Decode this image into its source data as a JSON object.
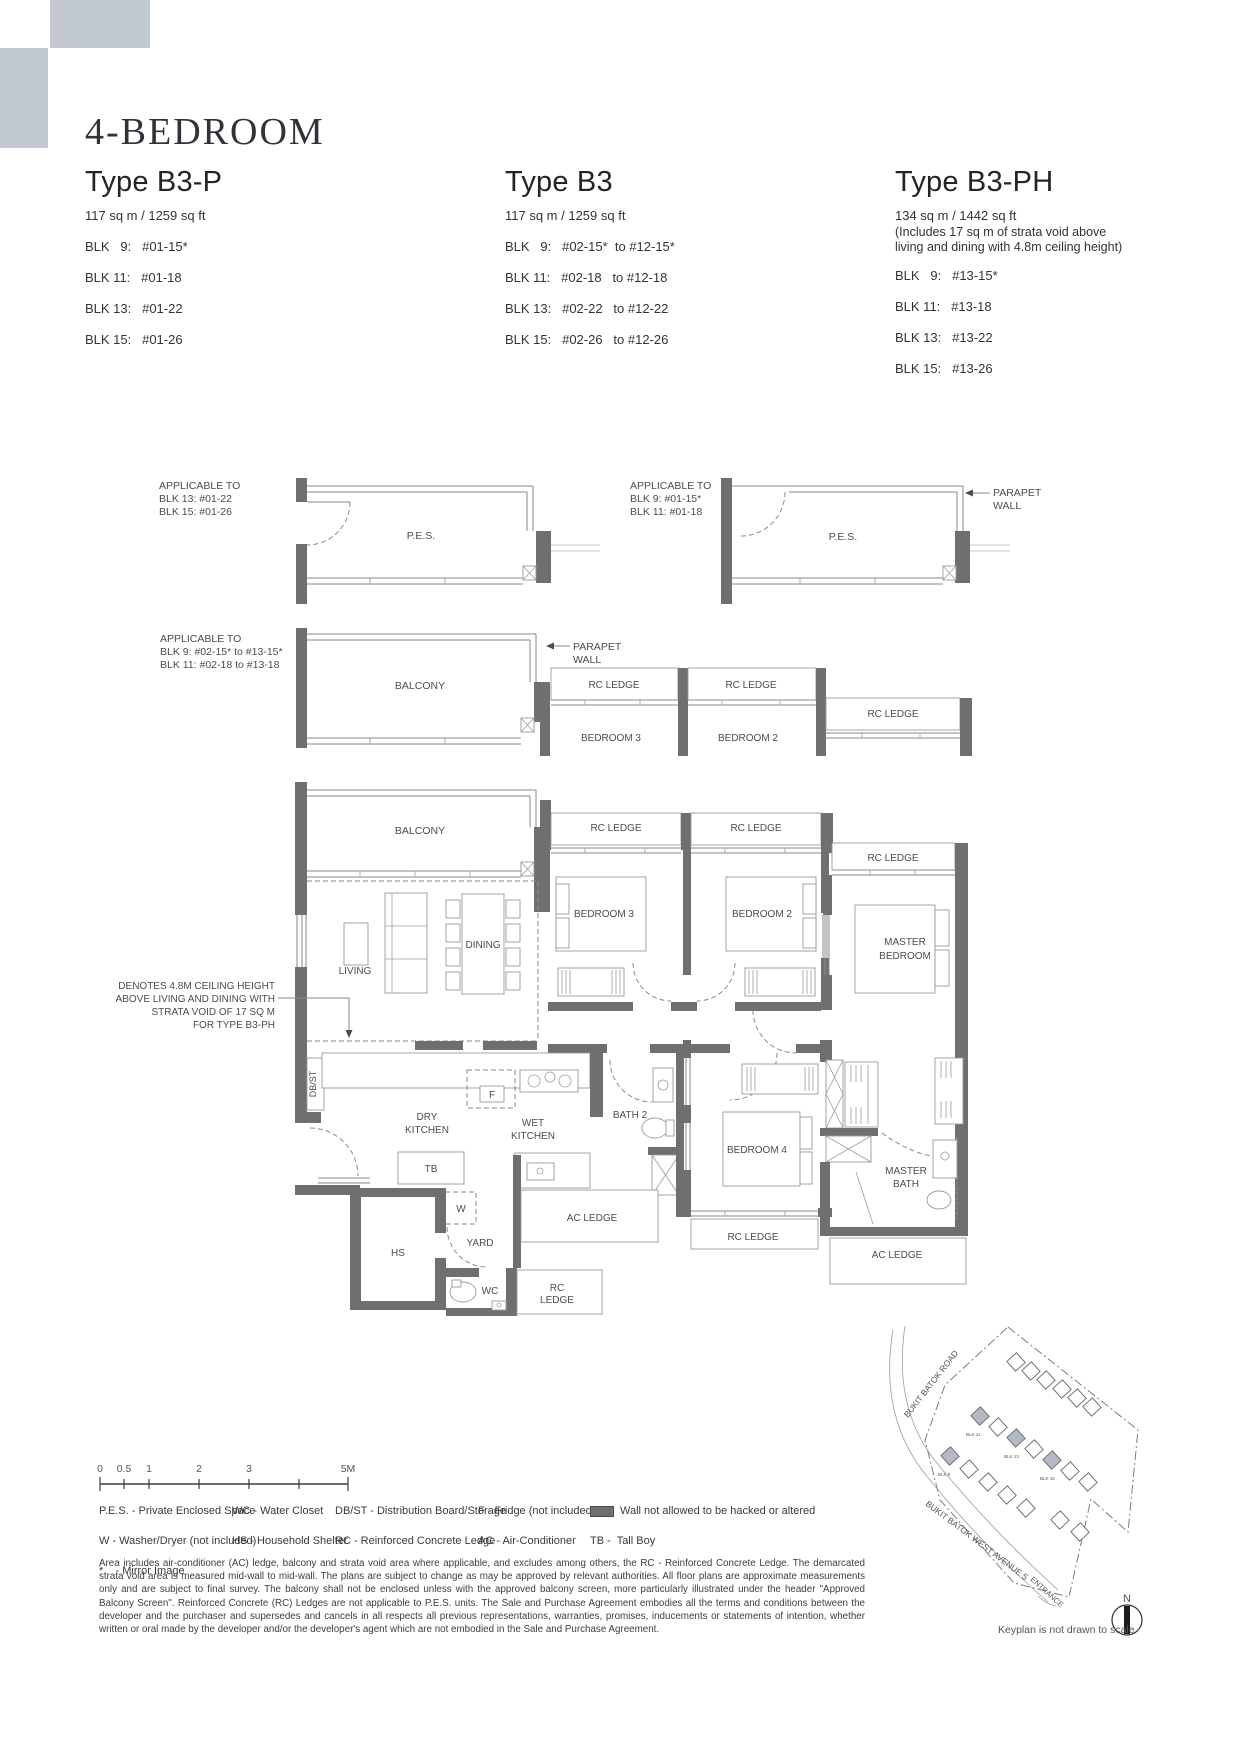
{
  "header": {
    "title": "4-BEDROOM",
    "types": [
      {
        "name": "Type B3-P",
        "area": "117 sq m / 1259 sq ft",
        "blk": [
          "BLK   9:   #01-15*",
          "BLK 11:   #01-18",
          "BLK 13:   #01-22",
          "BLK 15:   #01-26"
        ]
      },
      {
        "name": "Type B3",
        "area": "117 sq m / 1259 sq ft",
        "blk": [
          "BLK   9:   #02-15*  to #12-15*",
          "BLK 11:   #02-18   to #12-18",
          "BLK 13:   #02-22   to #12-22",
          "BLK 15:   #02-26   to #12-26"
        ]
      },
      {
        "name": "Type B3-PH",
        "area": "134 sq m / 1442 sq ft",
        "note1": "(Includes 17 sq m of strata void above",
        "note2": "living and dining with 4.8m ceiling height)",
        "blk": [
          "BLK   9:   #13-15*",
          "BLK 11:   #13-18",
          "BLK 13:   #13-22",
          "BLK 15:   #13-26"
        ]
      }
    ]
  },
  "plan": {
    "applicable_pes_left": [
      "APPLICABLE TO",
      "BLK 13:   #01-22",
      "BLK 15:   #01-26"
    ],
    "applicable_pes_right": [
      "APPLICABLE TO",
      "BLK   9:   #01-15*",
      "BLK 11:   #01-18"
    ],
    "applicable_balcony": [
      "APPLICABLE TO",
      "BLK   9:   #02-15* to #13-15*",
      "BLK 11:   #02-18  to #13-18"
    ],
    "labels": {
      "pes": "P.E.S.",
      "balcony": "BALCONY",
      "rc_ledge": "RC LEDGE",
      "parapet_1": "PARAPET",
      "parapet_2": "WALL",
      "living": "LIVING",
      "dining": "DINING",
      "bedroom3": "BEDROOM 3",
      "bedroom2": "BEDROOM 2",
      "bedroom4": "BEDROOM 4",
      "master_1": "MASTER",
      "master_2": "BEDROOM",
      "masterbath_1": "MASTER",
      "masterbath_2": "BATH",
      "bath2": "BATH 2",
      "dry_1": "DRY",
      "dry_2": "KITCHEN",
      "wet_1": "WET",
      "wet_2": "KITCHEN",
      "yard": "YARD",
      "hs": "HS",
      "wc": "WC",
      "tb": "TB",
      "w": "W",
      "f": "F",
      "dbst": "DB/ST",
      "ac_ledge": "AC LEDGE",
      "rc_1": "RC",
      "rc_2": "LEDGE"
    },
    "strata_note": [
      "DENOTES 4.8M CEILING HEIGHT",
      "ABOVE LIVING AND DINING WITH",
      "STRATA VOID OF 17 SQ M",
      "FOR TYPE B3-PH"
    ]
  },
  "scalebar": {
    "ticks": [
      "0",
      "0.5",
      "1",
      "2",
      "3",
      "5M"
    ]
  },
  "legend": {
    "col1": [
      "P.E.S. - Private Enclosed Space",
      "W - Washer/Dryer (not included)",
      "*    - Mirror Image"
    ],
    "col2": [
      "WC - Water Closet",
      "HS - Household Shelter"
    ],
    "col3": [
      "DB/ST - Distribution Board/Storage",
      "RC - Reinforced Concrete Ledge"
    ],
    "col4": [
      "F - Fridge (not included)",
      "AC - Air-Conditioner"
    ],
    "wall_note": "Wall not allowed to be hacked or altered",
    "tb_note": "TB -  Tall Boy"
  },
  "disclaimer": "Area includes air-conditioner (AC) ledge, balcony and strata void area where applicable, and excludes among others, the RC - Reinforced Concrete Ledge. The demarcated strata void area is measured mid-wall to mid-wall. The plans are subject to change as may be approved by relevant authorities. All floor plans are approximate measurements only and are subject to final survey. The balcony shall not be enclosed unless with the approved balcony screen, more particularly illustrated under the header \"Approved Balcony Screen\". Reinforced Concrete (RC) Ledges are not applicable to P.E.S. units. The Sale and Purchase Agreement embodies all the terms and conditions between the developer and the purchaser and supersedes and cancels in all respects all previous representations, warranties, promises, inducements or statements of intention, whether written or oral made by the developer and/or the developer's agent which are not embodied in the Sale and Purchase Agreement.",
  "keyplan": {
    "road1": "BUKIT BATOK ROAD",
    "road2": "BUKIT BATOK WEST AVENUE 5",
    "entrance": "ENTRANCE",
    "north": "N",
    "note": "Keyplan is not drawn to scale",
    "blocks": [
      "BLK 11",
      "BLK 13",
      "BLK 15",
      "BLK 9"
    ]
  },
  "colors": {
    "accent_block": "#c3c9d1",
    "wall": "#6f6f6f",
    "line": "#8a8a8a",
    "text": "#3c3c3c"
  }
}
